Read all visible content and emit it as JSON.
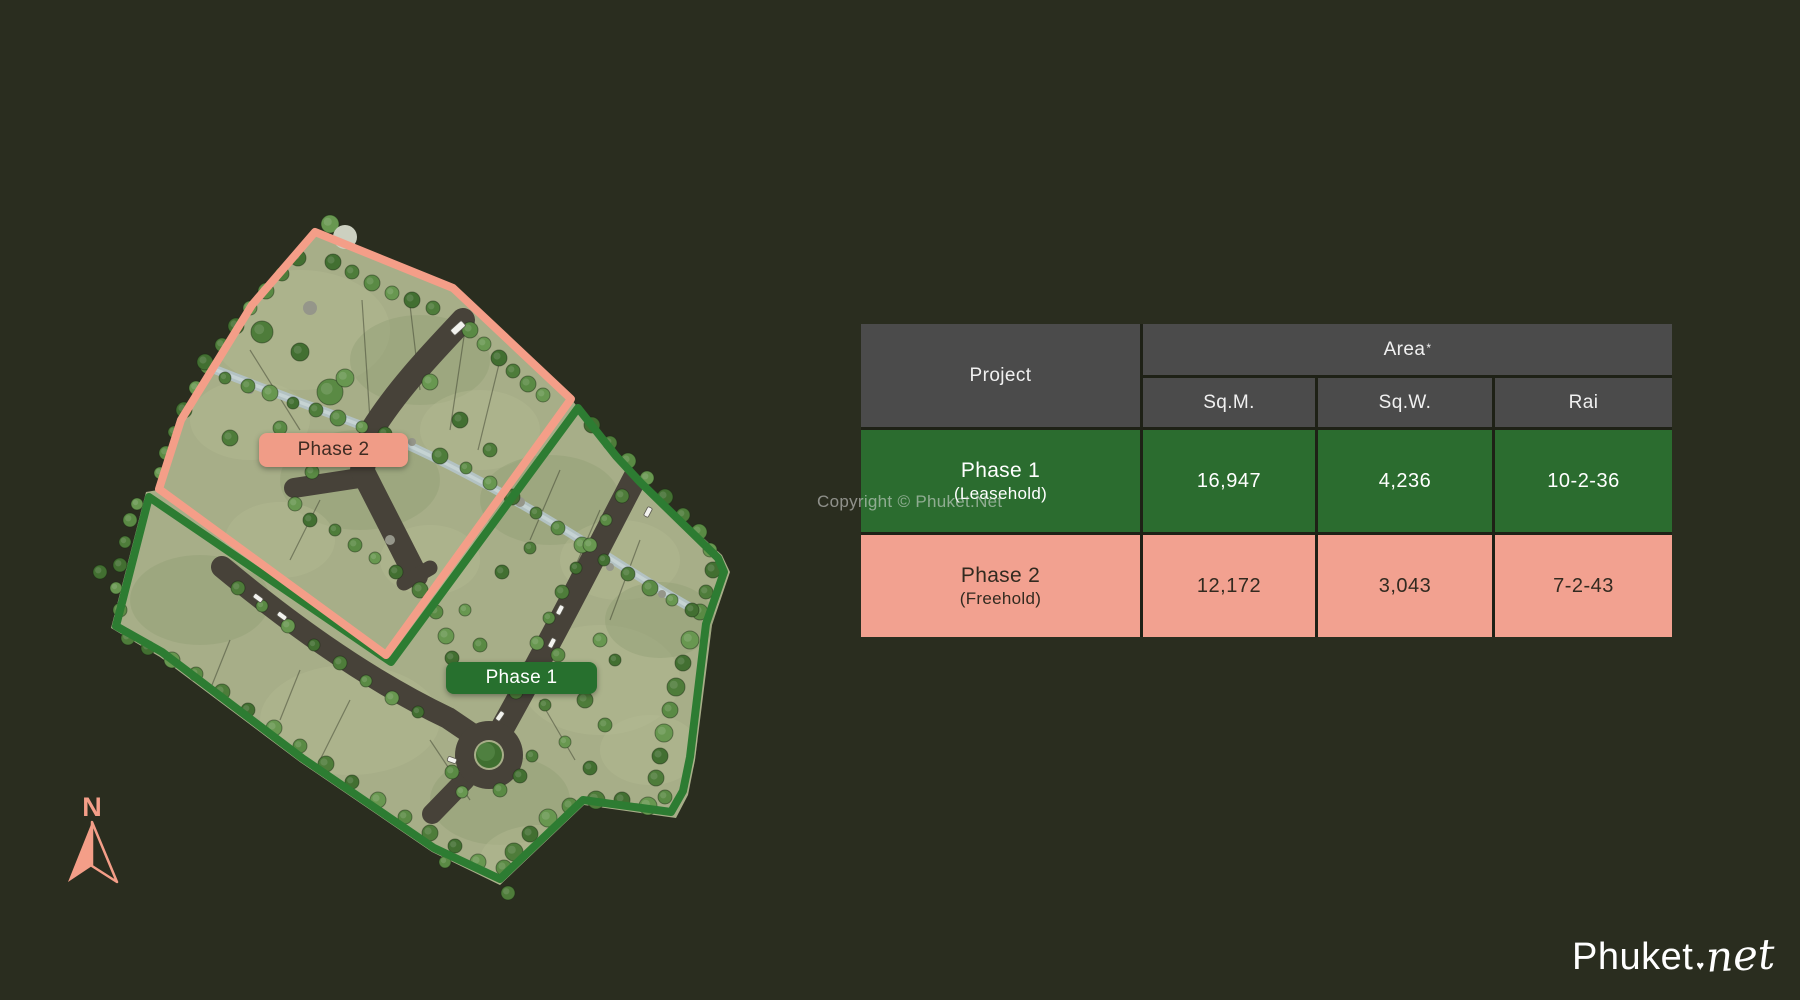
{
  "map": {
    "phase2_label": "Phase 2",
    "phase1_label": "Phase 1",
    "compass_n": "N"
  },
  "table": {
    "header": {
      "project": "Project",
      "area": "Area",
      "area_asterisk": "*",
      "columns": [
        "Sq.M.",
        "Sq.W.",
        "Rai"
      ]
    },
    "rows": [
      {
        "phase": "Phase 1",
        "tenure": "(Leasehold)",
        "sqm": "16,947",
        "sqw": "4,236",
        "rai": "10-2-36"
      },
      {
        "phase": "Phase 2",
        "tenure": "(Freehold)",
        "sqm": "12,172",
        "sqw": "3,043",
        "rai": "7-2-43"
      }
    ]
  },
  "watermark": "Copyright © Phuket.Net",
  "logo": {
    "brand": "Phuket",
    "dot": "♥",
    "tld": "net"
  },
  "colors": {
    "background": "#2a2d1f",
    "salmon": "#f49e88",
    "green": "#2d7c32",
    "table_header_gray": "#4b4b4b",
    "table_green_row": "#2b6c2f",
    "table_salmon_row": "#f2a190",
    "grass": "#a7ae88",
    "road": "#474239",
    "stream": "#b3c3c6"
  }
}
